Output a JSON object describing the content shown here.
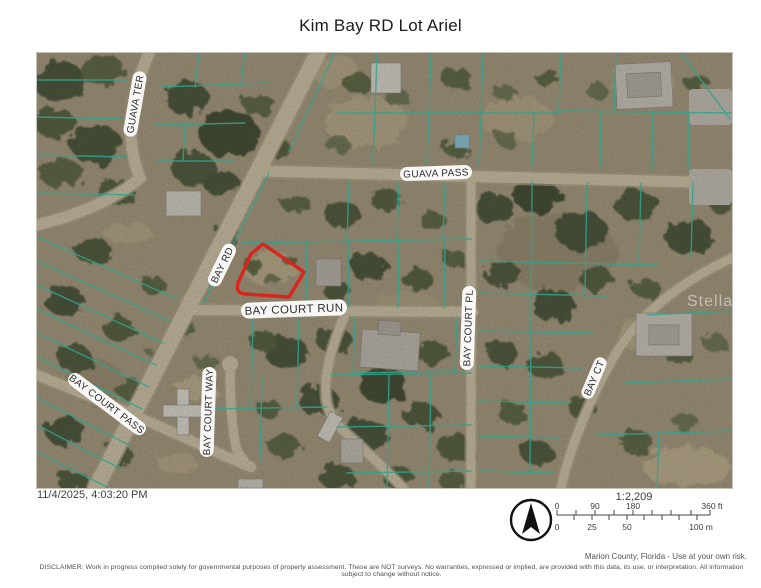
{
  "title": "Kim Bay RD Lot Ariel",
  "map": {
    "streets": [
      {
        "name": "GUAVA TER"
      },
      {
        "name": "GUAVA PASS"
      },
      {
        "name": "BAY RD"
      },
      {
        "name": "BAY COURT RUN"
      },
      {
        "name": "BAY COURT PL"
      },
      {
        "name": "BAY CT"
      },
      {
        "name": "BAY COURT PASS"
      },
      {
        "name": "BAY COURT WAY"
      }
    ],
    "highlight_color": "#da251d",
    "parcel_line_color": "#2ea58e",
    "watermark": "StellarMLS"
  },
  "footer": {
    "timestamp": "11/4/2025, 4:03:20 PM",
    "scale": {
      "ratio": "1:2,209",
      "feet_labels": [
        "0",
        "90",
        "180",
        "360 ft"
      ],
      "meter_labels": [
        "0",
        "25",
        "50",
        "100 m"
      ]
    },
    "attribution": "Marion County, Florida - Use at your own risk.",
    "disclaimer": "DISCLAIMER: Work in progress compiled solely for governmental purposes of property assessment. These are NOT surveys. No warranties, expressed or implied, are provided with this data, its use, or interpretation. All information subject to change without notice."
  }
}
